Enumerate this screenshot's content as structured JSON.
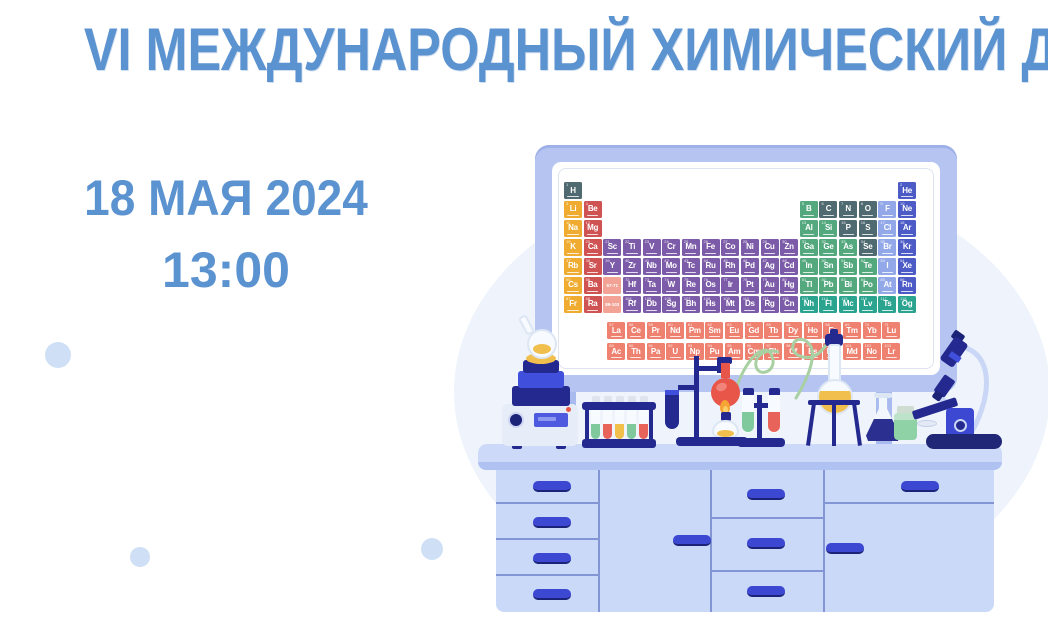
{
  "title": "VI МЕЖДУНАРОДНЫЙ ХИМИЧЕСКИЙ ДИКТАНТ",
  "event": {
    "date": "18 МАЯ 2024",
    "time": "13:00"
  },
  "colors": {
    "title_text": "#5b92d0",
    "background": "#ffffff",
    "background_circle": "#eef3fc",
    "decor_dots": "#cfe0f6",
    "whiteboard_frame": "#b5c4f1",
    "furniture": "#cbd9f9",
    "furniture_counter": "#ccd9f8",
    "illustration_navy": "#23298f",
    "handle_blue": "#3c47d2"
  },
  "illustration": {
    "items": [
      "whiteboard-with-periodic-table",
      "hotplate-stirrer",
      "heating-flask",
      "test-tube-rack",
      "retort-stand",
      "clamped-test-tube",
      "round-bottom-flask",
      "spirit-burner",
      "test-tube-holder-stand",
      "tripod-stand",
      "florence-flask",
      "erlenmeyer-flask",
      "reagent-jar",
      "petri-dish",
      "microscope",
      "lab-bench"
    ],
    "periodic_table": {
      "palette": {
        "nm": "#4f6a70",
        "am": "#efac30",
        "ae": "#d05353",
        "tm": "#7c5ca9",
        "pm": "#54a87e",
        "hal": "#92a8e8",
        "ng": "#4c5bc6",
        "new": "#2aa38f",
        "lan": "#ee8170",
        "act": "#ee8170",
        "ph": "#f2a396"
      },
      "rows": [
        [
          [
            1,
            "H",
            "nm",
            0
          ],
          [
            2,
            "He",
            "ng",
            17
          ]
        ],
        [
          [
            3,
            "Li",
            "am",
            0
          ],
          [
            4,
            "Be",
            "ae",
            1
          ],
          [
            5,
            "B",
            "pm",
            12
          ],
          [
            6,
            "C",
            "nm",
            13
          ],
          [
            7,
            "N",
            "nm",
            14
          ],
          [
            8,
            "O",
            "nm",
            15
          ],
          [
            9,
            "F",
            "hal",
            16
          ],
          [
            10,
            "Ne",
            "ng",
            17
          ]
        ],
        [
          [
            11,
            "Na",
            "am",
            0
          ],
          [
            12,
            "Mg",
            "ae",
            1
          ],
          [
            13,
            "Al",
            "pm",
            12
          ],
          [
            14,
            "Si",
            "pm",
            13
          ],
          [
            15,
            "P",
            "nm",
            14
          ],
          [
            16,
            "S",
            "nm",
            15
          ],
          [
            17,
            "Cl",
            "hal",
            16
          ],
          [
            18,
            "Ar",
            "ng",
            17
          ]
        ],
        [
          [
            19,
            "K",
            "am",
            0
          ],
          [
            20,
            "Ca",
            "ae",
            1
          ],
          [
            21,
            "Sc",
            "tm",
            2
          ],
          [
            22,
            "Ti",
            "tm",
            3
          ],
          [
            23,
            "V",
            "tm",
            4
          ],
          [
            24,
            "Cr",
            "tm",
            5
          ],
          [
            25,
            "Mn",
            "tm",
            6
          ],
          [
            26,
            "Fe",
            "tm",
            7
          ],
          [
            27,
            "Co",
            "tm",
            8
          ],
          [
            28,
            "Ni",
            "tm",
            9
          ],
          [
            29,
            "Cu",
            "tm",
            10
          ],
          [
            30,
            "Zn",
            "tm",
            11
          ],
          [
            31,
            "Ga",
            "pm",
            12
          ],
          [
            32,
            "Ge",
            "pm",
            13
          ],
          [
            33,
            "As",
            "pm",
            14
          ],
          [
            34,
            "Se",
            "nm",
            15
          ],
          [
            35,
            "Br",
            "hal",
            16
          ],
          [
            36,
            "Kr",
            "ng",
            17
          ]
        ],
        [
          [
            37,
            "Rb",
            "am",
            0
          ],
          [
            38,
            "Sr",
            "ae",
            1
          ],
          [
            39,
            "Y",
            "tm",
            2
          ],
          [
            40,
            "Zr",
            "tm",
            3
          ],
          [
            41,
            "Nb",
            "tm",
            4
          ],
          [
            42,
            "Mo",
            "tm",
            5
          ],
          [
            43,
            "Tc",
            "tm",
            6
          ],
          [
            44,
            "Ru",
            "tm",
            7
          ],
          [
            45,
            "Rh",
            "tm",
            8
          ],
          [
            46,
            "Pd",
            "tm",
            9
          ],
          [
            47,
            "Ag",
            "tm",
            10
          ],
          [
            48,
            "Cd",
            "tm",
            11
          ],
          [
            49,
            "In",
            "pm",
            12
          ],
          [
            50,
            "Sn",
            "pm",
            13
          ],
          [
            51,
            "Sb",
            "pm",
            14
          ],
          [
            52,
            "Te",
            "pm",
            15
          ],
          [
            53,
            "I",
            "hal",
            16
          ],
          [
            54,
            "Xe",
            "ng",
            17
          ]
        ],
        [
          [
            55,
            "Cs",
            "am",
            0
          ],
          [
            56,
            "Ba",
            "ae",
            1
          ],
          [
            "57-71",
            "",
            "ph",
            2
          ],
          [
            72,
            "Hf",
            "tm",
            3
          ],
          [
            73,
            "Ta",
            "tm",
            4
          ],
          [
            74,
            "W",
            "tm",
            5
          ],
          [
            75,
            "Re",
            "tm",
            6
          ],
          [
            76,
            "Os",
            "tm",
            7
          ],
          [
            77,
            "Ir",
            "tm",
            8
          ],
          [
            78,
            "Pt",
            "tm",
            9
          ],
          [
            79,
            "Au",
            "tm",
            10
          ],
          [
            80,
            "Hg",
            "tm",
            11
          ],
          [
            81,
            "Tl",
            "pm",
            12
          ],
          [
            82,
            "Pb",
            "pm",
            13
          ],
          [
            83,
            "Bi",
            "pm",
            14
          ],
          [
            84,
            "Po",
            "pm",
            15
          ],
          [
            85,
            "At",
            "hal",
            16
          ],
          [
            86,
            "Rn",
            "ng",
            17
          ]
        ],
        [
          [
            87,
            "Fr",
            "am",
            0
          ],
          [
            88,
            "Ra",
            "ae",
            1
          ],
          [
            "89-103",
            "",
            "ph",
            2
          ],
          [
            104,
            "Rf",
            "tm",
            3
          ],
          [
            105,
            "Db",
            "tm",
            4
          ],
          [
            106,
            "Sg",
            "tm",
            5
          ],
          [
            107,
            "Bh",
            "tm",
            6
          ],
          [
            108,
            "Hs",
            "tm",
            7
          ],
          [
            109,
            "Mt",
            "tm",
            8
          ],
          [
            110,
            "Ds",
            "tm",
            9
          ],
          [
            111,
            "Rg",
            "tm",
            10
          ],
          [
            112,
            "Cn",
            "tm",
            11
          ],
          [
            113,
            "Nh",
            "new",
            12
          ],
          [
            114,
            "Fl",
            "new",
            13
          ],
          [
            115,
            "Mc",
            "new",
            14
          ],
          [
            116,
            "Lv",
            "new",
            15
          ],
          [
            117,
            "Ts",
            "new",
            16
          ],
          [
            118,
            "Og",
            "new",
            17
          ]
        ]
      ],
      "f_rows": [
        {
          "category": "lan",
          "cells": [
            [
              57,
              "La"
            ],
            [
              58,
              "Ce"
            ],
            [
              59,
              "Pr"
            ],
            [
              60,
              "Nd"
            ],
            [
              61,
              "Pm"
            ],
            [
              62,
              "Sm"
            ],
            [
              63,
              "Eu"
            ],
            [
              64,
              "Gd"
            ],
            [
              65,
              "Tb"
            ],
            [
              66,
              "Dy"
            ],
            [
              67,
              "Ho"
            ],
            [
              68,
              "Er"
            ],
            [
              69,
              "Tm"
            ],
            [
              70,
              "Yb"
            ],
            [
              71,
              "Lu"
            ]
          ]
        },
        {
          "category": "act",
          "cells": [
            [
              89,
              "Ac"
            ],
            [
              90,
              "Th"
            ],
            [
              91,
              "Pa"
            ],
            [
              92,
              "U"
            ],
            [
              93,
              "Np"
            ],
            [
              94,
              "Pu"
            ],
            [
              95,
              "Am"
            ],
            [
              96,
              "Cm"
            ],
            [
              97,
              "Bk"
            ],
            [
              98,
              "Cf"
            ],
            [
              99,
              "Es"
            ],
            [
              100,
              "Fm"
            ],
            [
              101,
              "Md"
            ],
            [
              102,
              "No"
            ],
            [
              103,
              "Lr"
            ]
          ]
        }
      ]
    }
  }
}
